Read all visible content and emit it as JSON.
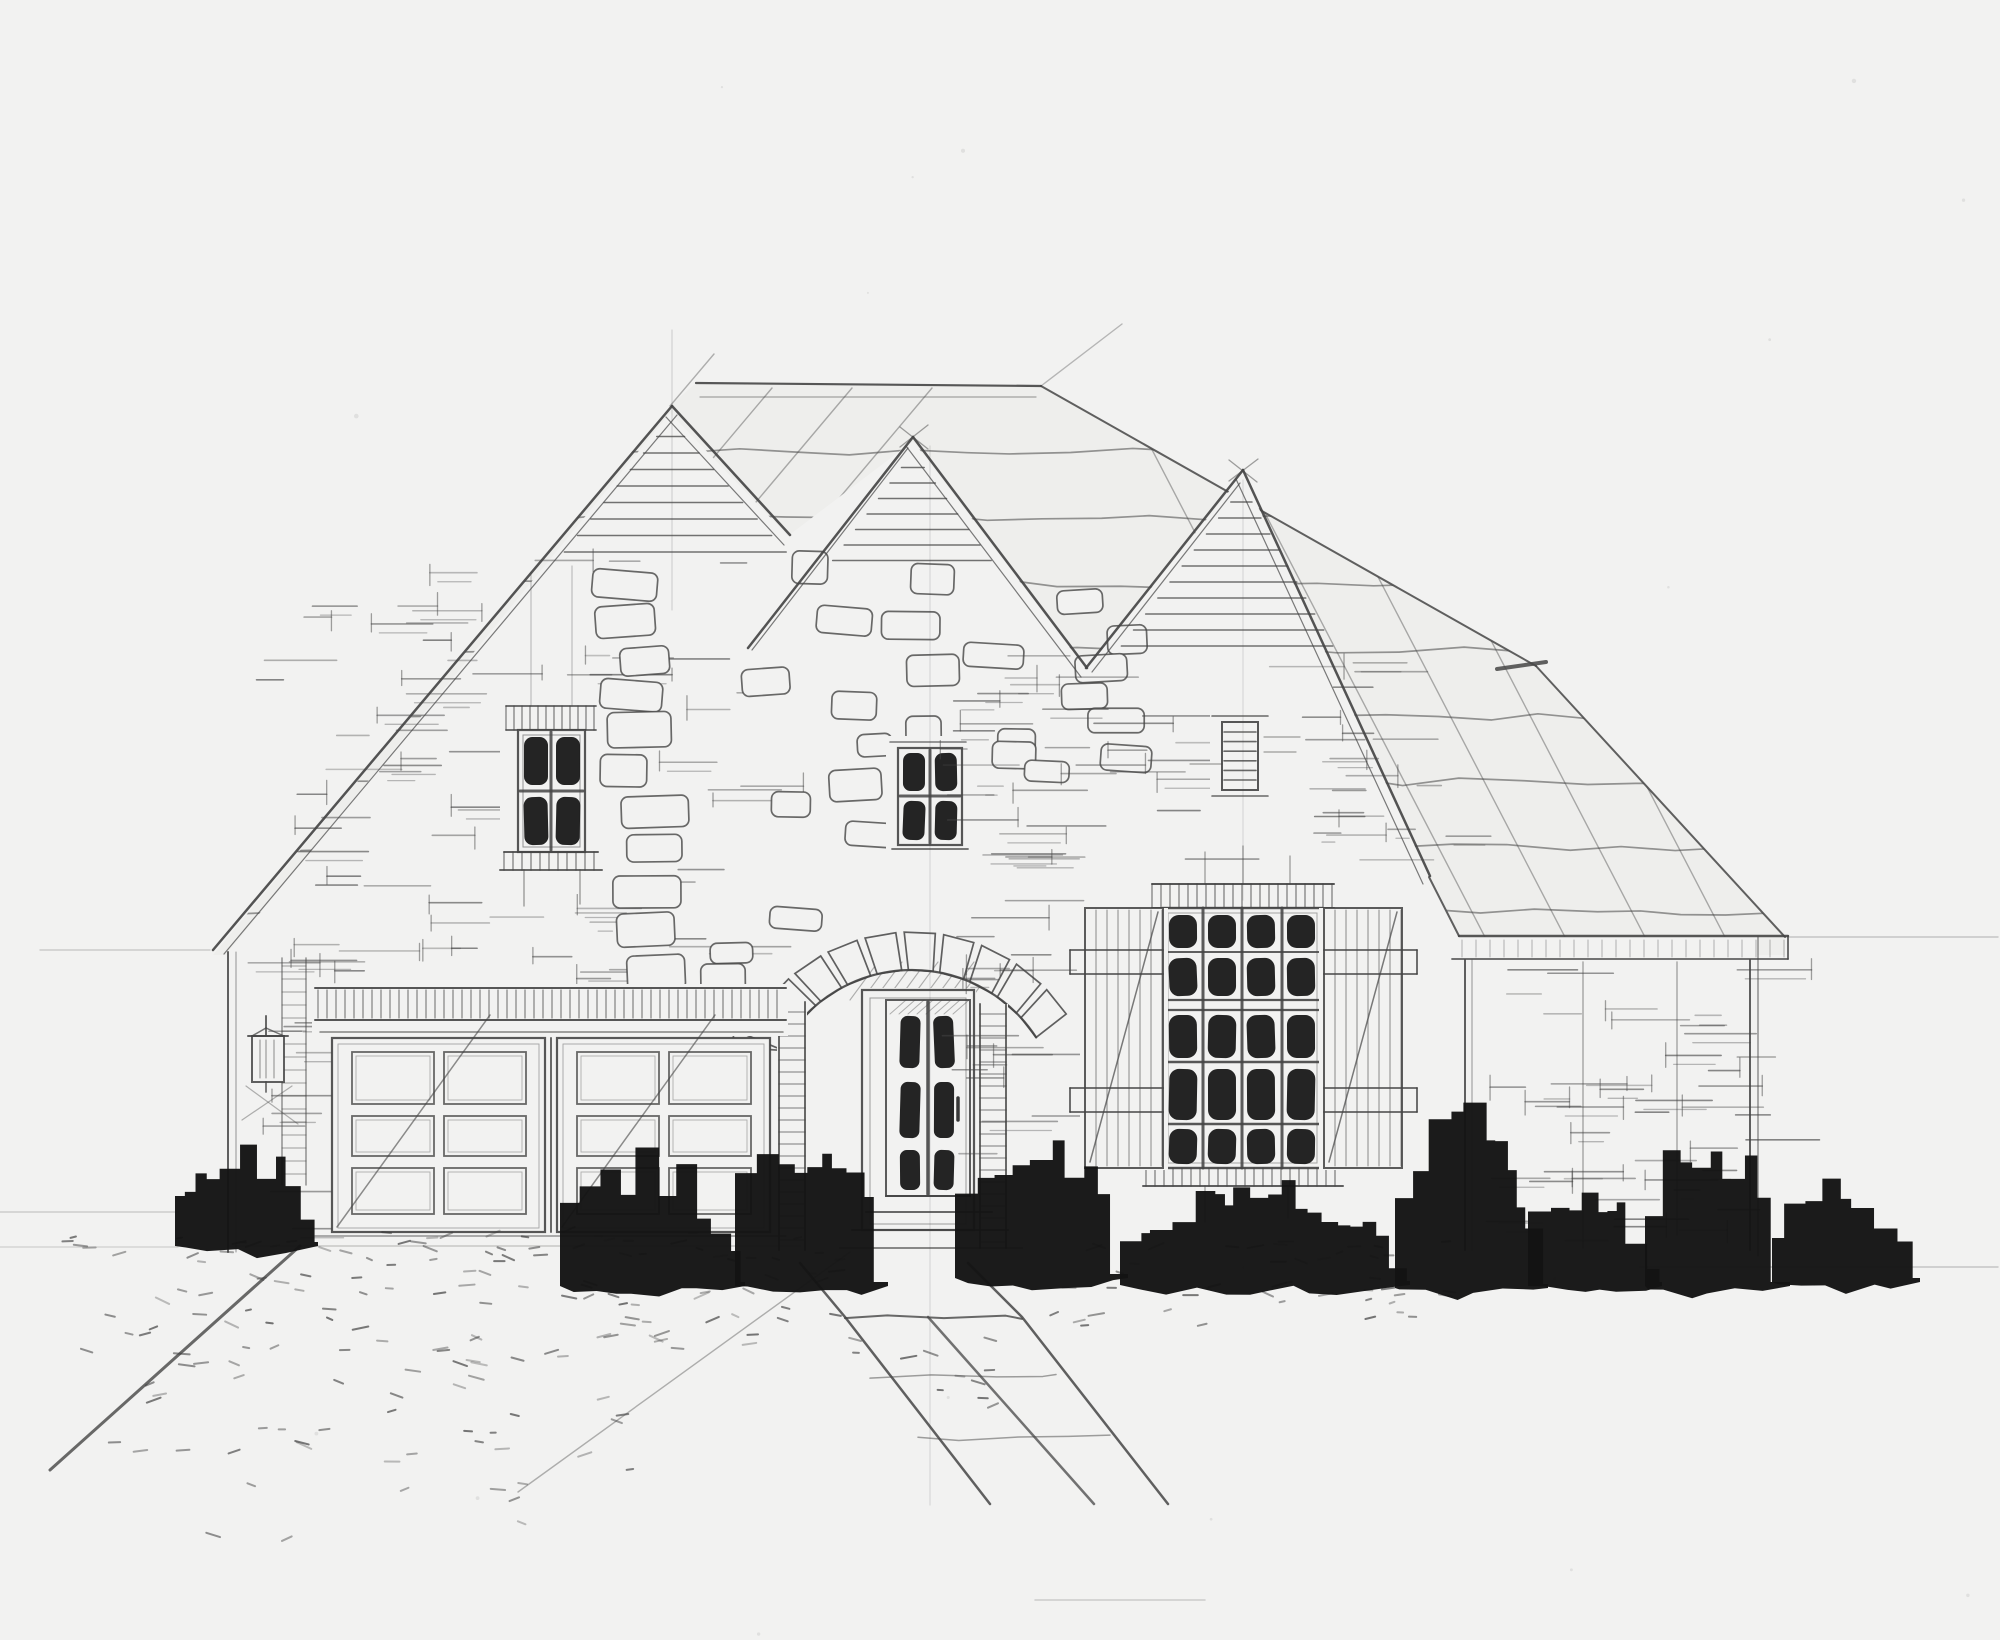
{
  "meta": {
    "description": "Hand-drawn pencil and ink architectural front-elevation sketch of a single-story brick house with three steep front gables, a stone-arched entry door, a two-car garage with paneled doors, a large shuttered multi-pane window, a gable vent louver, solid black ink foundation shrubs, a pebbled driveway and a flagstone walkway on light drafting paper."
  },
  "palette": {
    "paper": "#f2f2f1",
    "roof_wash": "#eeeeec",
    "pencil": "#454545",
    "pencil_light": "#8c8c8c",
    "ink": "#161616"
  },
  "elements": {
    "gables": {
      "count": 3,
      "peak_siding_slats": [
        8,
        7,
        10
      ],
      "wall_finish": "sketched brick coursing"
    },
    "left_gable_window": {
      "pane_columns": 2,
      "pane_rows": 2,
      "dark_glass": true
    },
    "entry_gable_window": {
      "pane_columns": 2,
      "pane_rows": 2,
      "dark_glass": true
    },
    "attic_louver": {
      "slats": 6
    },
    "main_window": {
      "pane_columns": 4,
      "pane_rows": 5,
      "transom_rows": 2
    },
    "shutters": {
      "count": 2,
      "style": "vertical board with battens and diagonal brace"
    },
    "entry_door": {
      "pane_columns": 2,
      "pane_rows": 3,
      "surround": "radiating stone arch with ladder-coursed jambs"
    },
    "garage": {
      "doors": 2,
      "panel_columns": 2,
      "panel_rows": 3,
      "header": "ticked lintel band"
    },
    "porch_lantern": {
      "count": 1
    },
    "landscape": {
      "shrub_clusters": 6,
      "driveway": "pebbled, edged left",
      "walkway": "flagstone path angling right"
    }
  }
}
